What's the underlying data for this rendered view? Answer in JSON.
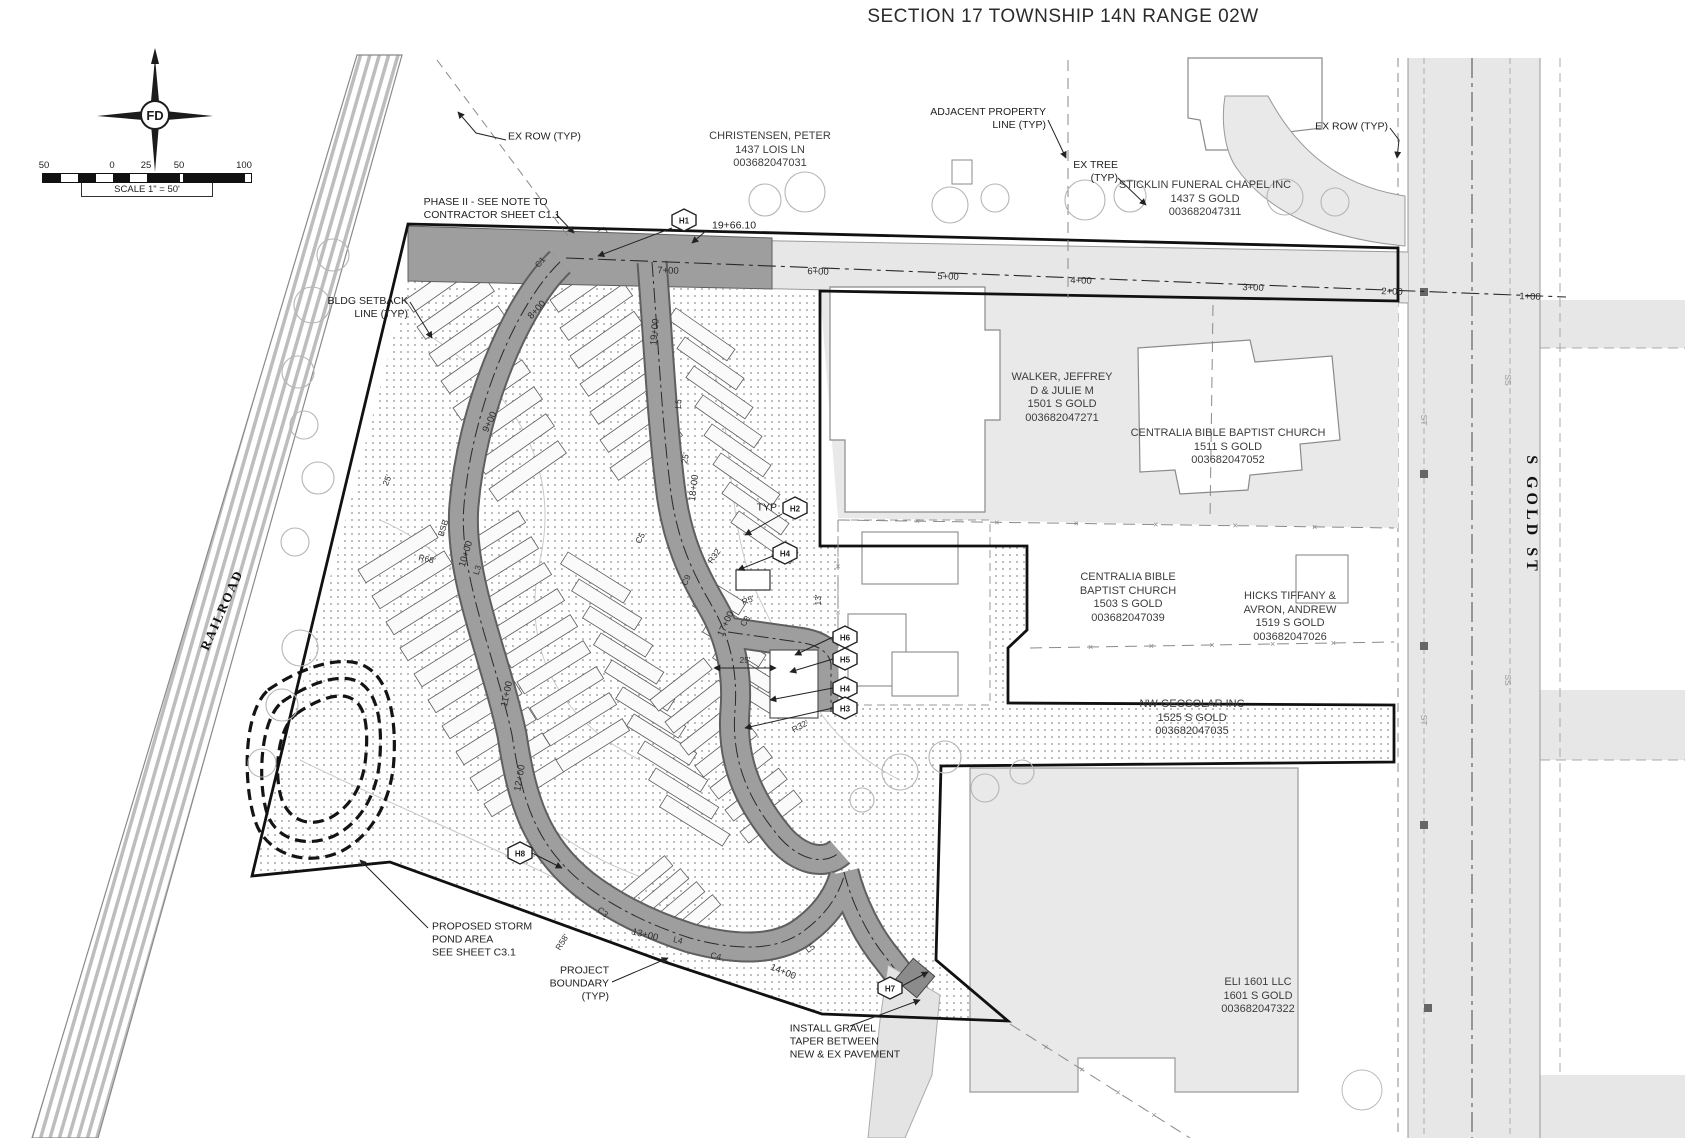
{
  "title": "SECTION 17 TOWNSHIP 14N RANGE 02W",
  "compass": {
    "logo": "FD"
  },
  "scale_bar": {
    "tick_labels": [
      {
        "t": "50",
        "x": 2
      },
      {
        "t": "0",
        "x": 70
      },
      {
        "t": "25",
        "x": 104
      },
      {
        "t": "50",
        "x": 137
      },
      {
        "t": "100",
        "x": 202
      }
    ],
    "caption": "SCALE 1\" = 50'"
  },
  "streets": {
    "railroad": "RAILROAD",
    "gold": "S GOLD ST"
  },
  "colors": {
    "proposed_road": "#9e9e9e",
    "road_edge": "#5f5f5f",
    "existing_pavement": "#e7e7e7",
    "parcel_gray": "#e9e9e9",
    "hatch_dot": "#8f8f8f",
    "boundary": "#111111"
  },
  "parcel_labels": [
    {
      "name": "christensen",
      "text": "CHRISTENSEN, PETER\n1437 LOIS LN\n003682047031",
      "x": 770,
      "y": 150
    },
    {
      "name": "sticklin",
      "text": "STICKLIN FUNERAL CHAPEL INC\n1437 S GOLD\n003682047311",
      "x": 1205,
      "y": 199
    },
    {
      "name": "walker",
      "text": "WALKER, JEFFREY\nD & JULIE M\n1501 S GOLD\n003682047271",
      "x": 1062,
      "y": 398
    },
    {
      "name": "centralia-1511",
      "text": "CENTRALIA BIBLE BAPTIST CHURCH\n1511 S GOLD\n003682047052",
      "x": 1228,
      "y": 447
    },
    {
      "name": "centralia-1503",
      "text": "CENTRALIA BIBLE\nBAPTIST CHURCH\n1503 S GOLD\n003682047039",
      "x": 1128,
      "y": 598
    },
    {
      "name": "hicks",
      "text": "HICKS TIFFANY &\nAVRON, ANDREW\n1519 S GOLD\n003682047026",
      "x": 1290,
      "y": 617
    },
    {
      "name": "nw-geosolar",
      "text": "NW GEOSOLAR INC\n1525 S GOLD\n003682047035",
      "x": 1192,
      "y": 718
    },
    {
      "name": "eli",
      "text": "ELI 1601 LLC\n1601 S GOLD\n003682047322",
      "x": 1258,
      "y": 996
    }
  ],
  "callouts": [
    {
      "name": "ex-row-left",
      "text": "EX ROW (TYP)",
      "x": 508,
      "y": 137,
      "align": "left"
    },
    {
      "name": "phase-ii",
      "text": "PHASE II - SEE NOTE TO\nCONTRACTOR SHEET C1.1",
      "x": 492,
      "y": 209,
      "align": "center"
    },
    {
      "name": "adjacent-property-line",
      "text": "ADJACENT PROPERTY\nLINE (TYP)",
      "x": 1046,
      "y": 119,
      "align": "right"
    },
    {
      "name": "ex-tree",
      "text": "EX TREE\n(TYP)",
      "x": 1118,
      "y": 172,
      "align": "right"
    },
    {
      "name": "ex-row-right",
      "text": "EX ROW (TYP)",
      "x": 1388,
      "y": 127,
      "align": "right"
    },
    {
      "name": "bldg-setback",
      "text": "BLDG SETBACK\nLINE (TYP)",
      "x": 408,
      "y": 308,
      "align": "right"
    },
    {
      "name": "storm-pond",
      "text": "PROPOSED STORM\nPOND AREA\nSEE SHEET C3.1",
      "x": 432,
      "y": 940,
      "align": "left"
    },
    {
      "name": "project-boundary",
      "text": "PROJECT\nBOUNDARY\n(TYP)",
      "x": 609,
      "y": 984,
      "align": "right"
    },
    {
      "name": "gravel-taper",
      "text": "INSTALL GRAVEL\nTAPER BETWEEN\nNEW & EX PAVEMENT",
      "x": 845,
      "y": 1042,
      "align": "center"
    },
    {
      "name": "station-19-66",
      "text": "19+66.10",
      "x": 712,
      "y": 226,
      "align": "left"
    },
    {
      "name": "typ-marker",
      "text": "TYP",
      "x": 777,
      "y": 508,
      "align": "right"
    }
  ],
  "stations": [
    {
      "t": "7+00",
      "x": 668,
      "y": 271,
      "r": 2
    },
    {
      "t": "6+00",
      "x": 818,
      "y": 272,
      "r": 2
    },
    {
      "t": "5+00",
      "x": 948,
      "y": 277,
      "r": 2
    },
    {
      "t": "4+00",
      "x": 1081,
      "y": 281,
      "r": 2
    },
    {
      "t": "3+00",
      "x": 1253,
      "y": 288,
      "r": 2
    },
    {
      "t": "2+00",
      "x": 1392,
      "y": 292,
      "r": 2
    },
    {
      "t": "1+00",
      "x": 1530,
      "y": 297,
      "r": 2
    },
    {
      "t": "8+00",
      "x": 537,
      "y": 310,
      "r": -47
    },
    {
      "t": "9+00",
      "x": 490,
      "y": 422,
      "r": -65
    },
    {
      "t": "10+00",
      "x": 466,
      "y": 554,
      "r": -73
    },
    {
      "t": "11+00",
      "x": 507,
      "y": 694,
      "r": -78
    },
    {
      "t": "12+00",
      "x": 520,
      "y": 778,
      "r": -80
    },
    {
      "t": "13+00",
      "x": 645,
      "y": 935,
      "r": 14
    },
    {
      "t": "14+00",
      "x": 783,
      "y": 972,
      "r": 22
    },
    {
      "t": "17+00",
      "x": 726,
      "y": 624,
      "r": -65
    },
    {
      "t": "18+00",
      "x": 694,
      "y": 488,
      "r": -83
    },
    {
      "t": "19+00",
      "x": 655,
      "y": 332,
      "r": -85
    }
  ],
  "road_labels": [
    {
      "t": "C1",
      "x": 540,
      "y": 262,
      "r": -50
    },
    {
      "t": "L3",
      "x": 477,
      "y": 570,
      "r": -73
    },
    {
      "t": "L4",
      "x": 678,
      "y": 940,
      "r": 13
    },
    {
      "t": "L5",
      "x": 678,
      "y": 404,
      "r": -85
    },
    {
      "t": "L5",
      "x": 810,
      "y": 948,
      "r": -35
    },
    {
      "t": "C3",
      "x": 603,
      "y": 912,
      "r": 40
    },
    {
      "t": "C4",
      "x": 716,
      "y": 956,
      "r": 12
    },
    {
      "t": "C5",
      "x": 640,
      "y": 538,
      "r": -60
    },
    {
      "t": "C8",
      "x": 745,
      "y": 621,
      "r": -55
    },
    {
      "t": "C9",
      "x": 686,
      "y": 580,
      "r": -65
    },
    {
      "t": "R5'",
      "x": 748,
      "y": 600,
      "r": -20
    },
    {
      "t": "R32",
      "x": 714,
      "y": 556,
      "r": -55
    },
    {
      "t": "R32'",
      "x": 800,
      "y": 726,
      "r": -28
    },
    {
      "t": "R68'",
      "x": 427,
      "y": 559,
      "r": 12
    },
    {
      "t": "BSB",
      "x": 443,
      "y": 528,
      "r": -73
    },
    {
      "t": "R58'",
      "x": 562,
      "y": 942,
      "r": -58
    },
    {
      "t": "25'",
      "x": 387,
      "y": 480,
      "r": -68
    },
    {
      "t": "25'",
      "x": 685,
      "y": 458,
      "r": -80
    },
    {
      "t": "25'",
      "x": 745,
      "y": 660,
      "r": 0
    },
    {
      "t": "13'",
      "x": 818,
      "y": 600,
      "r": -90
    },
    {
      "t": "ST",
      "x": 1424,
      "y": 420,
      "r": 90,
      "muted": true
    },
    {
      "t": "ST",
      "x": 1424,
      "y": 720,
      "r": 90,
      "muted": true
    },
    {
      "t": "SS",
      "x": 1508,
      "y": 380,
      "r": 90,
      "muted": true
    },
    {
      "t": "SS",
      "x": 1508,
      "y": 680,
      "r": 90,
      "muted": true
    }
  ],
  "hex_markers": [
    {
      "t": "H1",
      "x": 684,
      "y": 220
    },
    {
      "t": "H2",
      "x": 795,
      "y": 508
    },
    {
      "t": "H4",
      "x": 785,
      "y": 553
    },
    {
      "t": "H6",
      "x": 845,
      "y": 637
    },
    {
      "t": "H5",
      "x": 845,
      "y": 659
    },
    {
      "t": "H4",
      "x": 845,
      "y": 688
    },
    {
      "t": "H3",
      "x": 845,
      "y": 708
    },
    {
      "t": "H8",
      "x": 520,
      "y": 853
    },
    {
      "t": "H7",
      "x": 890,
      "y": 988
    }
  ]
}
